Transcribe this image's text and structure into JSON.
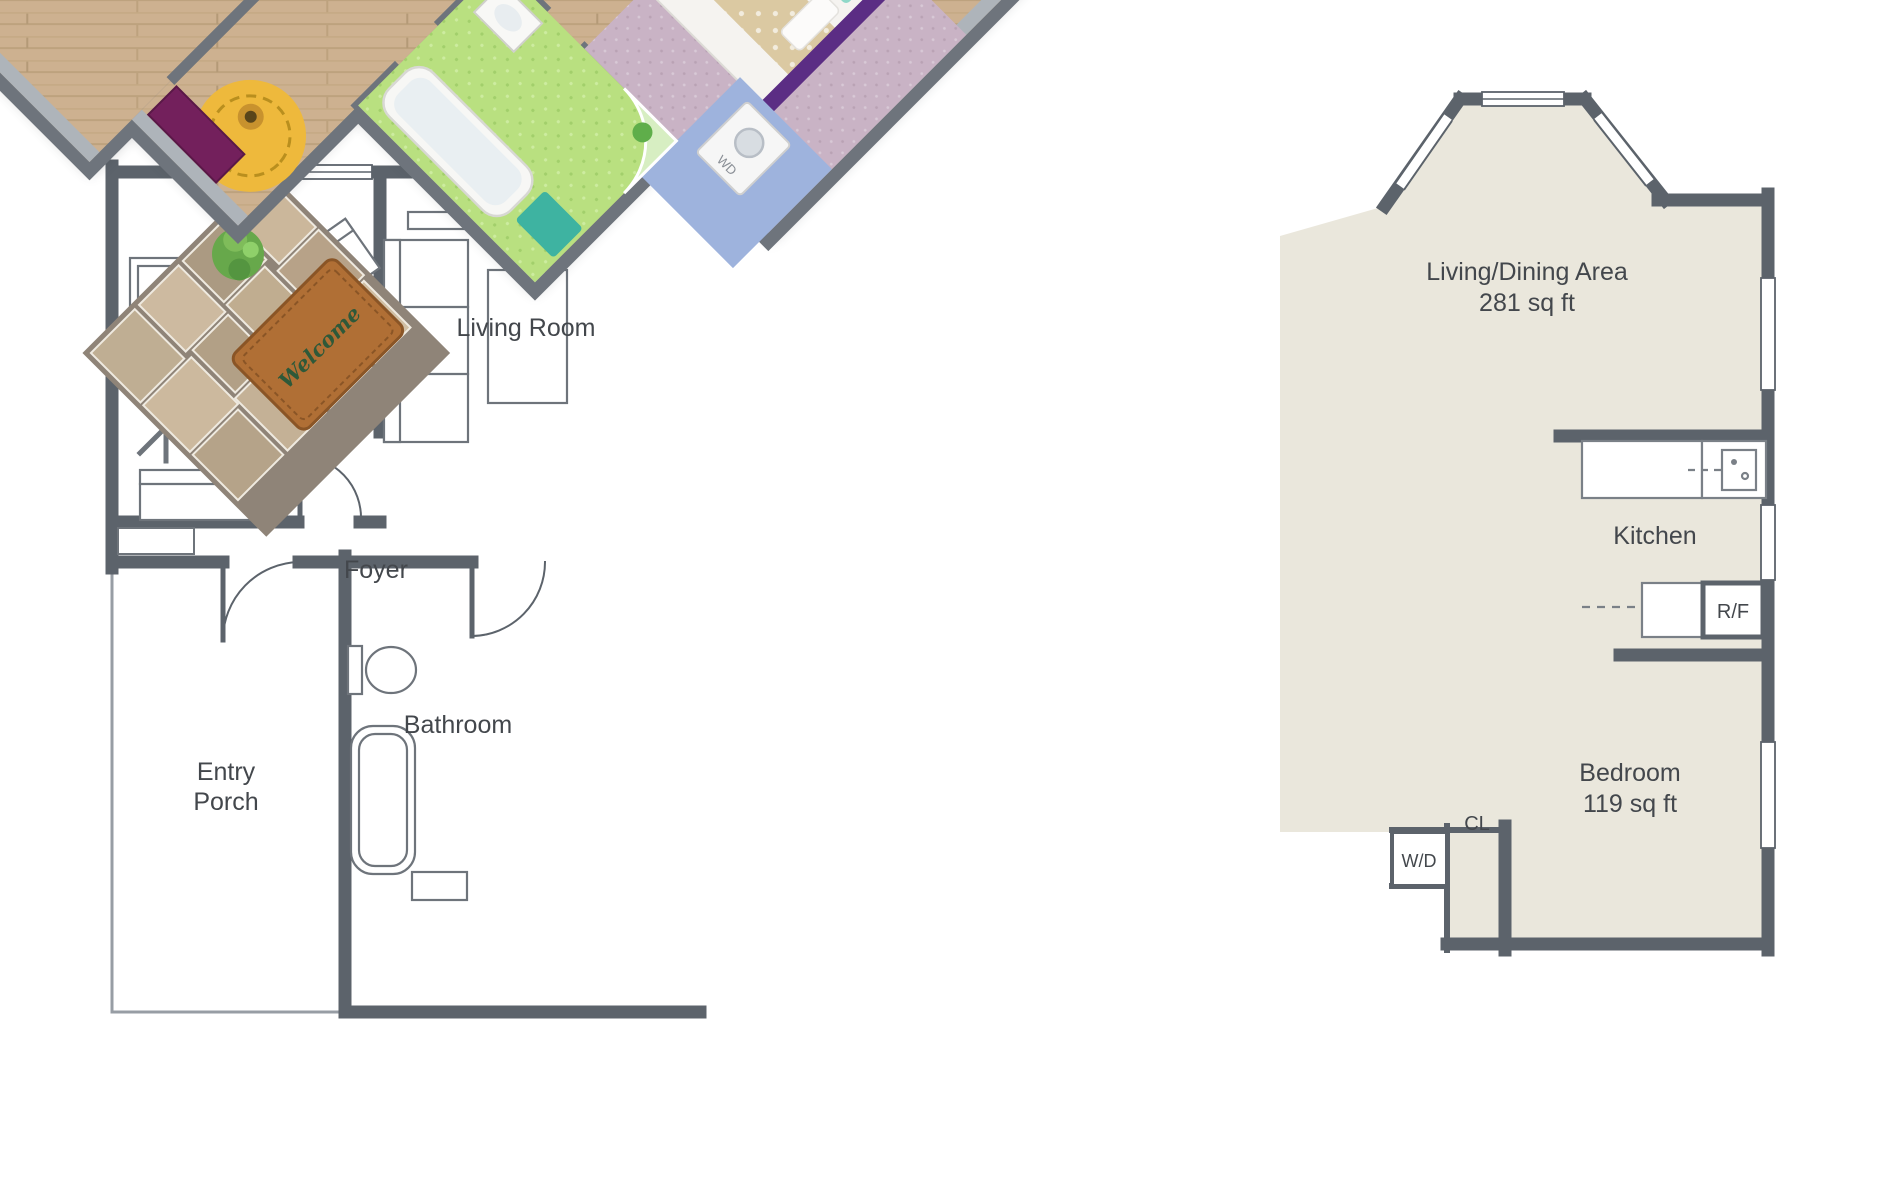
{
  "image": {
    "type": "floor plan",
    "description": "2D black-and-white apartment floor plan with a colorful 3D rendered floor plan overlay rotated 45 degrees"
  },
  "rooms_2d": {
    "nursery": {
      "label": "Nursery"
    },
    "living_room": {
      "label": "Living Room"
    },
    "foyer": {
      "label": "Foyer"
    },
    "bathroom": {
      "label": "Bathroom"
    },
    "entry_porch": {
      "line1": "Entry",
      "line2": "Porch"
    },
    "living_dining": {
      "label": "Living/Dining Area",
      "area": "281 sq ft"
    },
    "kitchen": {
      "label": "Kitchen"
    },
    "refrigerator": {
      "label": "R/F"
    },
    "bedroom": {
      "label": "Bedroom",
      "area": "119 sq ft"
    },
    "closet": {
      "label": "CL"
    },
    "washer_dryer": {
      "label": "W/D"
    }
  },
  "overlay_3d": {
    "welcome_mat": "Welcome",
    "washer_label": "WD"
  },
  "colors": {
    "wall_2d": "#5c636b",
    "floor_left": "#ffffff",
    "floor_right": "#eae7dc",
    "wall_3d_top": "#6e747c",
    "wall_3d_purple": "#731b5c",
    "wood_floor": "#cdb190",
    "rug_pink": "#d9aebc",
    "rug_teal": "#57cbb4",
    "rug_coral": "#f09a92",
    "bathroom_floor": "#b9e080",
    "rug_yellow": "#eeb93c",
    "welcome_mat_brown": "#b06f35",
    "laundry_floor_blue": "#9eb3dd",
    "accent_gold": "#ecc12f",
    "accent_magenta": "#b03468"
  }
}
